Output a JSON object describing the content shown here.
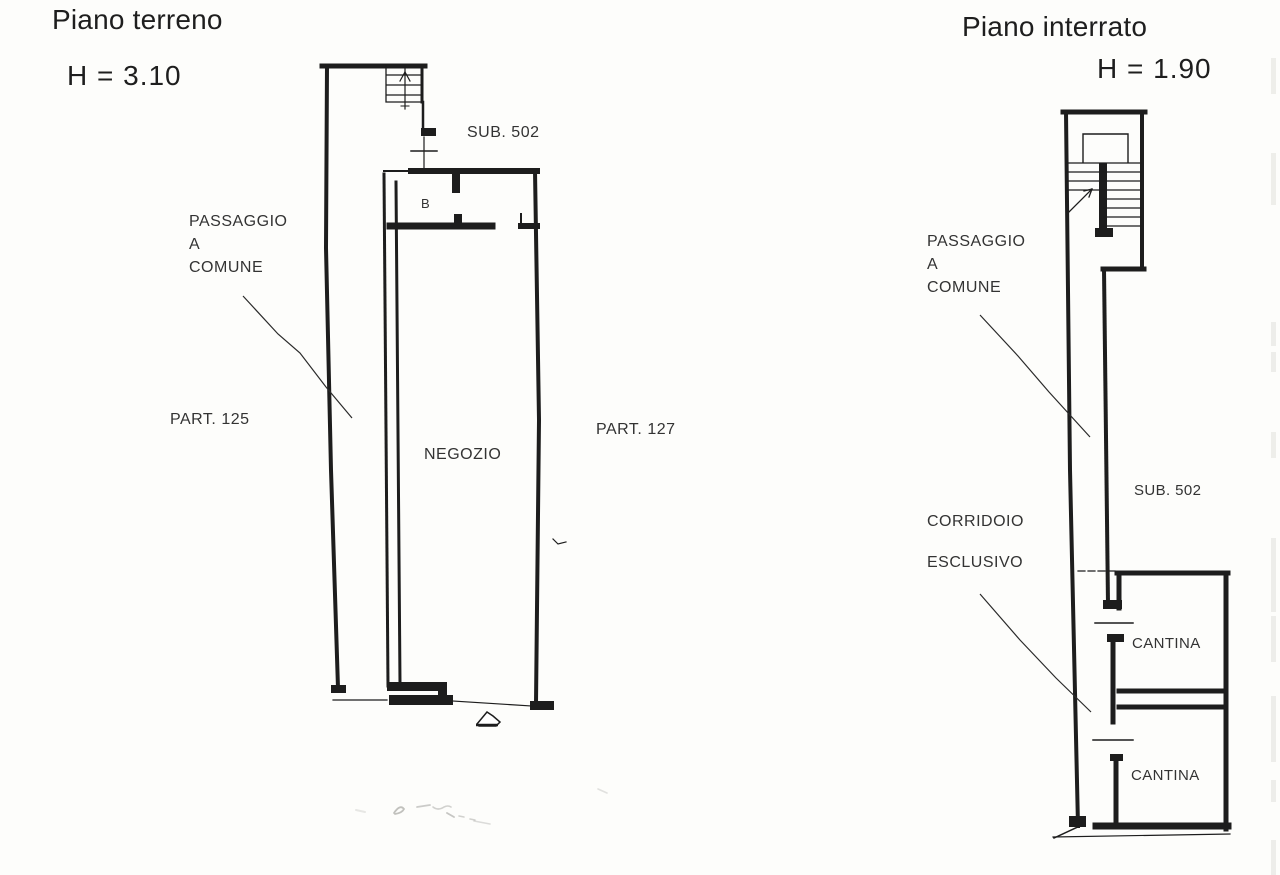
{
  "document": {
    "type_hint": "scanned cadastral floor plan",
    "background_color": "#fdfdfb",
    "ink_color": "#1d1d1d"
  },
  "plans": [
    {
      "id": "piano-terreno",
      "title": "Piano terreno",
      "height_note": "H = 3.10",
      "labels": {
        "sub": "SUB. 502",
        "passaggio_line1": "PASSAGGIO",
        "passaggio_line2": "A",
        "passaggio_line3": "COMUNE",
        "part_left": "PART. 125",
        "part_right": "PART. 127",
        "room": "NEGOZIO",
        "room_letter": "B"
      }
    },
    {
      "id": "piano-interrato",
      "title": "Piano interrato",
      "height_note": "H = 1.90",
      "labels": {
        "sub": "SUB. 502",
        "passaggio_line1": "PASSAGGIO",
        "passaggio_line2": "A",
        "passaggio_line3": "COMUNE",
        "corridoio": "CORRIDOIO",
        "esclusivo": "ESCLUSIVO",
        "cantina_upper": "CANTINA",
        "cantina_lower": "CANTINA"
      }
    }
  ]
}
